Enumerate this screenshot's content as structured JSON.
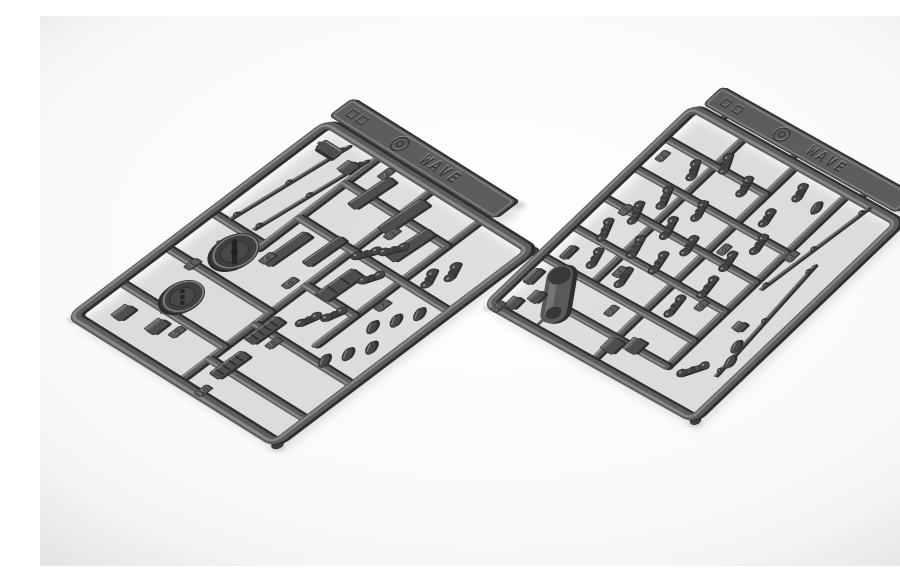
{
  "meta": {
    "description": "Product photo: two dark grey injection-molded plastic model kit sprues (parts runners) lying diagonally on a white studio background",
    "width": 900,
    "height": 550
  },
  "palette": {
    "background_center": "#ffffff",
    "background_mid": "#fafafa",
    "background_edge": "#eeeeee",
    "plastic_base": "#5d5d5d",
    "plastic_light": "#8f8f8f",
    "plastic_dark": "#3c3c3c",
    "plastic_darkest": "#2e2e2e",
    "part_fill": "#4e4e4e",
    "emboss_highlight": "#9b9b9b",
    "shadow": "#6f6f6f"
  },
  "emboss": {
    "brand_text": "WAVE",
    "mold_circle_mark_icon": "circled-mold-mark",
    "square_marks_icon": "molding-square-marks",
    "note": "raised lettering and marks on each runner tag"
  },
  "sprues": [
    {
      "id": "sprue-left",
      "origin": [
        32,
        300
      ],
      "axis_a": [
        255,
        -193
      ],
      "axis_b": [
        203,
        127
      ],
      "tab": {
        "u0": 102.5,
        "u1": 111.5,
        "v0": -2,
        "v1": 79
      },
      "tab_bridges": [
        6,
        36,
        66
      ],
      "runners": [
        [
          0,
          52,
          100,
          52
        ],
        [
          35,
          76,
          100,
          76
        ],
        [
          18,
          0,
          18,
          52
        ],
        [
          36,
          0,
          36,
          52
        ],
        [
          54,
          0,
          54,
          26
        ],
        [
          52,
          26,
          100,
          26
        ],
        [
          68,
          26,
          68,
          52
        ],
        [
          86,
          26,
          86,
          52
        ],
        [
          12,
          52,
          12,
          100
        ],
        [
          30,
          52,
          30,
          100
        ],
        [
          50,
          52,
          50,
          76
        ],
        [
          68,
          52,
          68,
          100
        ],
        [
          86,
          52,
          86,
          76
        ]
      ],
      "gates": [
        [
          47,
          13,
          47,
          21
        ],
        [
          17,
          23,
          24,
          23
        ],
        [
          93,
          5,
          93,
          10
        ]
      ],
      "parts": [
        {
          "t": "rod",
          "x1": 56,
          "y1": 8,
          "x2": 97,
          "y2": 14
        },
        {
          "t": "rod",
          "x1": 57,
          "y1": 18,
          "x2": 96,
          "y2": 24
        },
        {
          "t": "disc",
          "u": 47,
          "v": 21,
          "r": 8,
          "slot": true
        },
        {
          "t": "disc",
          "u": 25,
          "v": 23,
          "r": 7.2,
          "slot": false
        },
        {
          "t": "plate",
          "u": 93,
          "v": 10,
          "w": 9,
          "h": 4,
          "a": 90
        },
        {
          "t": "plate",
          "u": 88,
          "v": 37,
          "w": 15,
          "h": 4.5,
          "a": 5
        },
        {
          "t": "plate",
          "u": 87,
          "v": 54,
          "w": 16,
          "h": 5,
          "a": 5
        },
        {
          "t": "plate",
          "u": 80,
          "v": 66,
          "w": 15,
          "h": 5,
          "a": 5
        },
        {
          "t": "plate",
          "u": 57,
          "v": 34,
          "w": 16,
          "h": 4.5,
          "a": 3
        },
        {
          "t": "plate",
          "u": 63,
          "v": 45,
          "w": 14,
          "h": 4,
          "a": 3
        },
        {
          "t": "plate",
          "u": 56,
          "v": 61,
          "w": 14,
          "h": 6,
          "a": 3,
          "ridges": 2
        },
        {
          "t": "plate",
          "u": 30,
          "v": 57,
          "w": 12,
          "h": 5,
          "a": 2,
          "ridges": 4
        },
        {
          "t": "plate",
          "u": 14,
          "v": 60,
          "w": 12,
          "h": 5,
          "a": 2,
          "ridges": 4
        },
        {
          "t": "box",
          "u": 10,
          "v": 13,
          "w": 6,
          "h": 4
        },
        {
          "t": "box",
          "u": 12,
          "v": 27,
          "w": 6,
          "h": 4
        },
        {
          "t": "box",
          "u": 91,
          "v": 22,
          "w": 5,
          "h": 4
        },
        {
          "t": "link",
          "u": 70,
          "v": 57,
          "len": 6,
          "a": 35
        },
        {
          "t": "link",
          "u": 76,
          "v": 63,
          "len": 6,
          "a": 35
        },
        {
          "t": "link",
          "u": 64,
          "v": 67,
          "len": 5,
          "a": 30
        },
        {
          "t": "link",
          "u": 41,
          "v": 65,
          "len": 5,
          "a": 20
        },
        {
          "t": "link",
          "u": 47,
          "v": 70,
          "len": 5,
          "a": 20
        },
        {
          "t": "leaf",
          "u": 32,
          "v": 84,
          "a": -35
        },
        {
          "t": "leaf",
          "u": 38,
          "v": 88,
          "a": -35
        },
        {
          "t": "leaf",
          "u": 44,
          "v": 92,
          "a": -35
        },
        {
          "t": "leaf",
          "u": 50,
          "v": 85,
          "a": -35
        },
        {
          "t": "leaf",
          "u": 56,
          "v": 89,
          "a": -35
        },
        {
          "t": "leaf",
          "u": 62,
          "v": 93,
          "a": -35
        },
        {
          "t": "link",
          "u": 74,
          "v": 83,
          "len": 5,
          "a": -30
        },
        {
          "t": "link",
          "u": 80,
          "v": 87,
          "len": 5,
          "a": -30
        }
      ],
      "number_tabs": [
        {
          "n": "1",
          "u": 36,
          "v": 14
        },
        {
          "n": "2",
          "u": 96,
          "v": 34
        },
        {
          "n": "4",
          "u": 51,
          "v": 32
        },
        {
          "n": "5",
          "u": 14,
          "v": 34
        },
        {
          "n": "6",
          "u": 48,
          "v": 47
        },
        {
          "n": "8",
          "u": 28,
          "v": 64
        },
        {
          "n": "9",
          "u": 80,
          "v": 57
        },
        {
          "n": "7",
          "u": 58,
          "v": 80
        },
        {
          "n": "10",
          "u": 2,
          "v": 62
        }
      ]
    },
    {
      "id": "sprue-right",
      "origin": [
        448,
        288
      ],
      "axis_a": [
        205,
        -196
      ],
      "axis_b": [
        205,
        115
      ],
      "tab": {
        "u0": 103,
        "u1": 112,
        "v0": 2,
        "v1": 96
      },
      "tab_bridges": [
        12,
        46,
        80
      ],
      "runners": [
        [
          0,
          50,
          100,
          50
        ],
        [
          25,
          25,
          100,
          25
        ],
        [
          12,
          75,
          100,
          75
        ],
        [
          25,
          0,
          25,
          75
        ],
        [
          40,
          0,
          40,
          75
        ],
        [
          55,
          0,
          55,
          75
        ],
        [
          70,
          0,
          70,
          75
        ],
        [
          85,
          0,
          85,
          50
        ],
        [
          12,
          25,
          12,
          75
        ]
      ],
      "gates": [
        [
          0,
          22,
          9,
          22
        ],
        [
          22,
          13,
          25,
          11
        ]
      ],
      "parts": [
        {
          "t": "cap",
          "x1": 9,
          "y1": 23,
          "x2": 22,
          "y2": 13,
          "r": 4.6
        },
        {
          "t": "box",
          "u": 9,
          "v": 52,
          "w": 6,
          "h": 5
        },
        {
          "t": "box",
          "u": 13,
          "v": 59,
          "w": 6,
          "h": 5
        },
        {
          "t": "box",
          "u": 5,
          "v": 8,
          "w": 5,
          "h": 3.5
        },
        {
          "t": "box",
          "u": 11,
          "v": 13,
          "w": 5,
          "h": 3.5
        },
        {
          "t": "plate",
          "u": 17,
          "v": 5,
          "w": 7,
          "h": 3.5,
          "a": 0
        },
        {
          "t": "plate",
          "u": 31,
          "v": 8,
          "w": 6,
          "h": 3,
          "a": 0
        },
        {
          "t": "link",
          "u": 45,
          "v": 12,
          "len": 7,
          "a": -25
        },
        {
          "t": "link",
          "u": 56,
          "v": 16,
          "len": 7,
          "a": -25
        },
        {
          "t": "link",
          "u": 66,
          "v": 20,
          "len": 7,
          "a": -25
        },
        {
          "t": "link",
          "u": 34,
          "v": 18,
          "len": 6,
          "a": -20
        },
        {
          "t": "link",
          "u": 45,
          "v": 27,
          "len": 7,
          "a": -20
        },
        {
          "t": "link",
          "u": 57,
          "v": 31,
          "len": 7,
          "a": -20
        },
        {
          "t": "link",
          "u": 68,
          "v": 35,
          "len": 6,
          "a": -20
        },
        {
          "t": "link",
          "u": 33,
          "v": 33,
          "len": 6,
          "a": -15
        },
        {
          "t": "link",
          "u": 44,
          "v": 39,
          "len": 7,
          "a": -15
        },
        {
          "t": "link",
          "u": 55,
          "v": 43,
          "len": 6,
          "a": -15
        },
        {
          "t": "link",
          "u": 80,
          "v": 20,
          "len": 6,
          "a": -30
        },
        {
          "t": "link",
          "u": 88,
          "v": 28,
          "len": 6,
          "a": -30
        },
        {
          "t": "link",
          "u": 84,
          "v": 41,
          "len": 6,
          "a": -20
        },
        {
          "t": "link",
          "u": 33,
          "v": 58,
          "len": 7,
          "a": -10
        },
        {
          "t": "link",
          "u": 45,
          "v": 62,
          "len": 7,
          "a": -10
        },
        {
          "t": "link",
          "u": 57,
          "v": 60,
          "len": 6,
          "a": -15
        },
        {
          "t": "link",
          "u": 68,
          "v": 64,
          "len": 6,
          "a": -15
        },
        {
          "t": "link",
          "u": 78,
          "v": 58,
          "len": 5,
          "a": -15
        },
        {
          "t": "rod",
          "x1": 99,
          "y1": 86,
          "x2": 54,
          "y2": 79
        },
        {
          "t": "rod",
          "x1": 71,
          "y1": 88,
          "x2": 18,
          "y2": 93
        },
        {
          "t": "link",
          "u": 16,
          "v": 84,
          "len": 8,
          "a": 35
        },
        {
          "t": "leaf",
          "u": 25,
          "v": 93,
          "a": -20
        },
        {
          "t": "leaf",
          "u": 31,
          "v": 90,
          "a": -20
        },
        {
          "t": "box",
          "u": 38,
          "v": 85,
          "w": 4,
          "h": 3
        },
        {
          "t": "link",
          "u": 92,
          "v": 60,
          "len": 5,
          "a": -20
        },
        {
          "t": "leaf",
          "u": 90,
          "v": 70,
          "a": -20
        }
      ],
      "number_tabs": [
        {
          "n": "10",
          "u": 1,
          "v": 4
        },
        {
          "n": "2",
          "u": 79,
          "v": 6
        },
        {
          "n": "9",
          "u": 55,
          "v": 12
        },
        {
          "n": "7",
          "u": 20,
          "v": 40
        },
        {
          "n": "8",
          "u": 34,
          "v": 30
        },
        {
          "n": "5",
          "u": 60,
          "v": 55
        },
        {
          "n": "6",
          "u": 38,
          "v": 66
        },
        {
          "n": "4",
          "u": 70,
          "v": 78
        }
      ]
    }
  ]
}
